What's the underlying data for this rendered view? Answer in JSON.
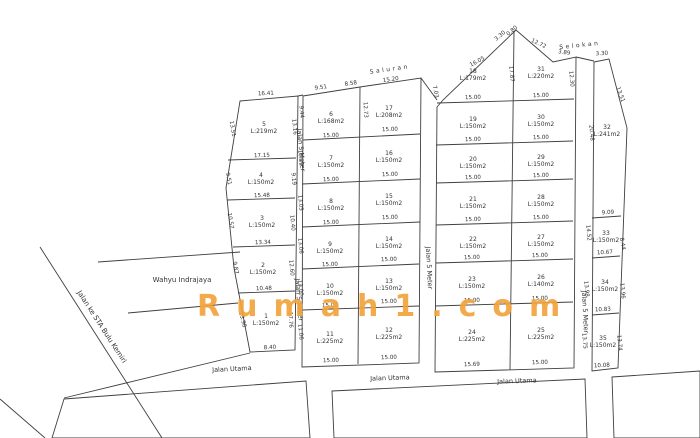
{
  "watermark": {
    "text": "Rumah1.com",
    "color": "#F2A33C"
  },
  "legend": {
    "plot_label_format": "number above, area below",
    "line_color": "#3f3f3f",
    "annotation_color": "#9a9a9a"
  },
  "plots": [
    [
      "1",
      "L:150m2",
      266,
      320
    ],
    [
      "2",
      "L:150m2",
      263,
      269
    ],
    [
      "3",
      "L:150m2",
      262,
      222
    ],
    [
      "4",
      "L:150m2",
      261,
      179
    ],
    [
      "5",
      "L:219m2",
      264,
      128
    ],
    [
      "6",
      "L:168m2",
      331,
      118
    ],
    [
      "7",
      "L:150m2",
      331,
      162
    ],
    [
      "8",
      "L:150m2",
      331,
      205
    ],
    [
      "9",
      "L:150m2",
      330,
      248
    ],
    [
      "10",
      "L:150m2",
      330,
      290
    ],
    [
      "11",
      "L:225m2",
      330,
      338
    ],
    [
      "12",
      "L:225m2",
      389,
      334
    ],
    [
      "13",
      "L:150m2",
      389,
      285
    ],
    [
      "14",
      "L:150m2",
      389,
      243
    ],
    [
      "15",
      "L:150m2",
      389,
      200
    ],
    [
      "16",
      "L:150m2",
      389,
      157
    ],
    [
      "17",
      "L:208m2",
      389,
      112
    ],
    [
      "18",
      "L:179m2",
      473,
      75
    ],
    [
      "19",
      "L:150m2",
      473,
      123
    ],
    [
      "20",
      "L:150m2",
      473,
      163
    ],
    [
      "21",
      "L:150m2",
      473,
      203
    ],
    [
      "22",
      "L:150m2",
      473,
      243
    ],
    [
      "23",
      "L:150m2",
      472,
      283
    ],
    [
      "24",
      "L:225m2",
      472,
      336
    ],
    [
      "25",
      "L:225m2",
      541,
      334
    ],
    [
      "26",
      "L:140m2",
      541,
      281
    ],
    [
      "27",
      "L:150m2",
      541,
      241
    ],
    [
      "28",
      "L:150m2",
      541,
      201
    ],
    [
      "29",
      "L:150m2",
      541,
      161
    ],
    [
      "30",
      "L:150m2",
      541,
      121
    ],
    [
      "31",
      "L:220m2",
      541,
      73
    ],
    [
      "32",
      "L:241m2",
      607,
      131
    ],
    [
      "33",
      "L:150m2",
      606,
      237
    ],
    [
      "34",
      "L:150m2",
      605,
      286
    ],
    [
      "35",
      "L:150m2",
      603,
      342
    ]
  ],
  "dims": [
    [
      "16.41",
      266,
      95,
      -3
    ],
    [
      "13.51",
      231,
      129,
      80
    ],
    [
      "13.16",
      293,
      127,
      85
    ],
    [
      "17.15",
      262,
      157,
      -2
    ],
    [
      "9.51",
      227,
      179,
      80
    ],
    [
      "9.19",
      292,
      179,
      85
    ],
    [
      "15.48",
      262,
      197,
      -2
    ],
    [
      "10.57",
      229,
      221,
      80
    ],
    [
      "10.40",
      291,
      223,
      85
    ],
    [
      "13.34",
      263,
      244,
      -2
    ],
    [
      "9.87",
      234,
      268,
      80
    ],
    [
      "12.60",
      290,
      268,
      85
    ],
    [
      "10.48",
      264,
      290,
      -2
    ],
    [
      "13.98",
      241,
      320,
      75
    ],
    [
      "17.76",
      289,
      320,
      87
    ],
    [
      "8.40",
      270,
      349,
      -2
    ],
    [
      "9.51",
      321,
      89,
      -8
    ],
    [
      "8.58",
      351,
      85,
      -8
    ],
    [
      "15.20",
      391,
      81,
      -8
    ],
    [
      "9.44",
      300,
      112,
      85
    ],
    [
      "10.29",
      299,
      158,
      85
    ],
    [
      "13.05",
      299,
      203,
      85
    ],
    [
      "13.06",
      299,
      246,
      85
    ],
    [
      "13.00",
      299,
      288,
      85
    ],
    [
      "11.06",
      299,
      332,
      85
    ],
    [
      "12.73",
      364,
      110,
      87
    ],
    [
      "15.00",
      331,
      137,
      -2
    ],
    [
      "15.00",
      331,
      181,
      -2
    ],
    [
      "15.00",
      331,
      224,
      -2
    ],
    [
      "15.00",
      330,
      266,
      -2
    ],
    [
      "15.00",
      330,
      307,
      -2
    ],
    [
      "15.00",
      331,
      362,
      -2
    ],
    [
      "15.00",
      390,
      131,
      -2
    ],
    [
      "15.00",
      390,
      176,
      -2
    ],
    [
      "15.00",
      390,
      219,
      -2
    ],
    [
      "15.00",
      389,
      261,
      -2
    ],
    [
      "15.00",
      389,
      303,
      -2
    ],
    [
      "15.00",
      389,
      359,
      -2
    ],
    [
      "16.05",
      478,
      63,
      -28
    ],
    [
      "3.30",
      501,
      37,
      -40
    ],
    [
      "0.80",
      513,
      32,
      -40
    ],
    [
      "12.72",
      538,
      45,
      25
    ],
    [
      "3.89",
      564,
      54,
      8
    ],
    [
      "7.03",
      434,
      92,
      78
    ],
    [
      "17.87",
      510,
      74,
      85
    ],
    [
      "12.30",
      570,
      79,
      85
    ],
    [
      "15.00",
      473,
      99,
      -2
    ],
    [
      "15.00",
      473,
      141,
      -2
    ],
    [
      "15.00",
      473,
      179,
      -2
    ],
    [
      "15.00",
      473,
      221,
      -2
    ],
    [
      "15.00",
      472,
      259,
      -2
    ],
    [
      "15.00",
      472,
      302,
      -2
    ],
    [
      "15.69",
      472,
      366,
      -2
    ],
    [
      "15.00",
      541,
      97,
      -2
    ],
    [
      "15.00",
      541,
      139,
      -2
    ],
    [
      "15.00",
      541,
      177,
      -2
    ],
    [
      "15.00",
      541,
      219,
      -2
    ],
    [
      "15.00",
      540,
      257,
      -2
    ],
    [
      "15.00",
      540,
      300,
      -2
    ],
    [
      "15.00",
      540,
      364,
      -2
    ],
    [
      "3.30",
      602,
      55,
      -4
    ],
    [
      "20.48",
      590,
      133,
      85
    ],
    [
      "13.51",
      619,
      95,
      70
    ],
    [
      "9.09",
      608,
      214,
      -3
    ],
    [
      "14.52",
      587,
      233,
      85
    ],
    [
      "8.44",
      621,
      244,
      80
    ],
    [
      "10.67",
      605,
      254,
      -3
    ],
    [
      "13.98",
      585,
      289,
      85
    ],
    [
      "13.96",
      621,
      291,
      85
    ],
    [
      "10.83",
      603,
      311,
      -3
    ],
    [
      "13.75",
      583,
      341,
      85
    ],
    [
      "13.74",
      618,
      343,
      85
    ],
    [
      "10.08",
      602,
      367,
      -3
    ]
  ],
  "road_labels": [
    [
      "Jalan 5 Meter",
      299,
      150,
      85
    ],
    [
      "Jalan 5 Meter",
      297,
      300,
      85
    ],
    [
      "Jalan 5 Meter",
      427,
      268,
      87
    ],
    [
      "Jalan 5 Meter",
      583,
      312,
      87
    ],
    [
      "Jalan Utama",
      232,
      371,
      -3
    ],
    [
      "Jalan Utama",
      390,
      380,
      -2
    ],
    [
      "Jalan Utama",
      517,
      383,
      -2
    ]
  ],
  "annotations": [
    [
      "Wahyu Indrajaya",
      182,
      282,
      0,
      "gray"
    ],
    [
      "Jalan ke STA Bulu Kemiri",
      100,
      328,
      57,
      "gray"
    ],
    [
      "Saluran",
      390,
      71,
      -8,
      "gray-spaced"
    ],
    [
      "Selokan",
      580,
      47,
      -6,
      "gray-spaced"
    ]
  ],
  "geometry": {
    "polygons": [
      "240,101 298,96 295,350 250,352 234,268 226,188",
      "303,96 360,87 421,78 419,363 302,367",
      "437,107 443,100 516,30 553,62 576,57 574,368 435,372",
      "594,62 609,59 627,128 618,368 592,371",
      "64,399 306,381 310,438 52,438",
      "332,391 585,379 587,438 334,438",
      "612,377 700,371 700,438 614,438"
    ],
    "lines": [
      "228,160 296,158",
      "227,200 295,198",
      "233,247 295,245",
      "238,293 295,291",
      "360,87 358,364",
      "303,140 420,134",
      "302,184 420,179",
      "302,227 420,222",
      "302,269 419,264",
      "302,310 419,306",
      "514,31 510,370",
      "437,103 574,99",
      "436,145 573,141",
      "436,183 573,179",
      "436,225 573,221",
      "436,263 573,259",
      "435,306 573,302",
      "592,218 621,216",
      "592,258 620,256",
      "592,315 619,313",
      "298,96 303,95",
      "421,78 437,100",
      "576,57 594,61",
      "40,247 162,438",
      "98,262 240,252",
      "128,313 238,303",
      "250,353 64,398",
      "0,399 45,438"
    ]
  }
}
